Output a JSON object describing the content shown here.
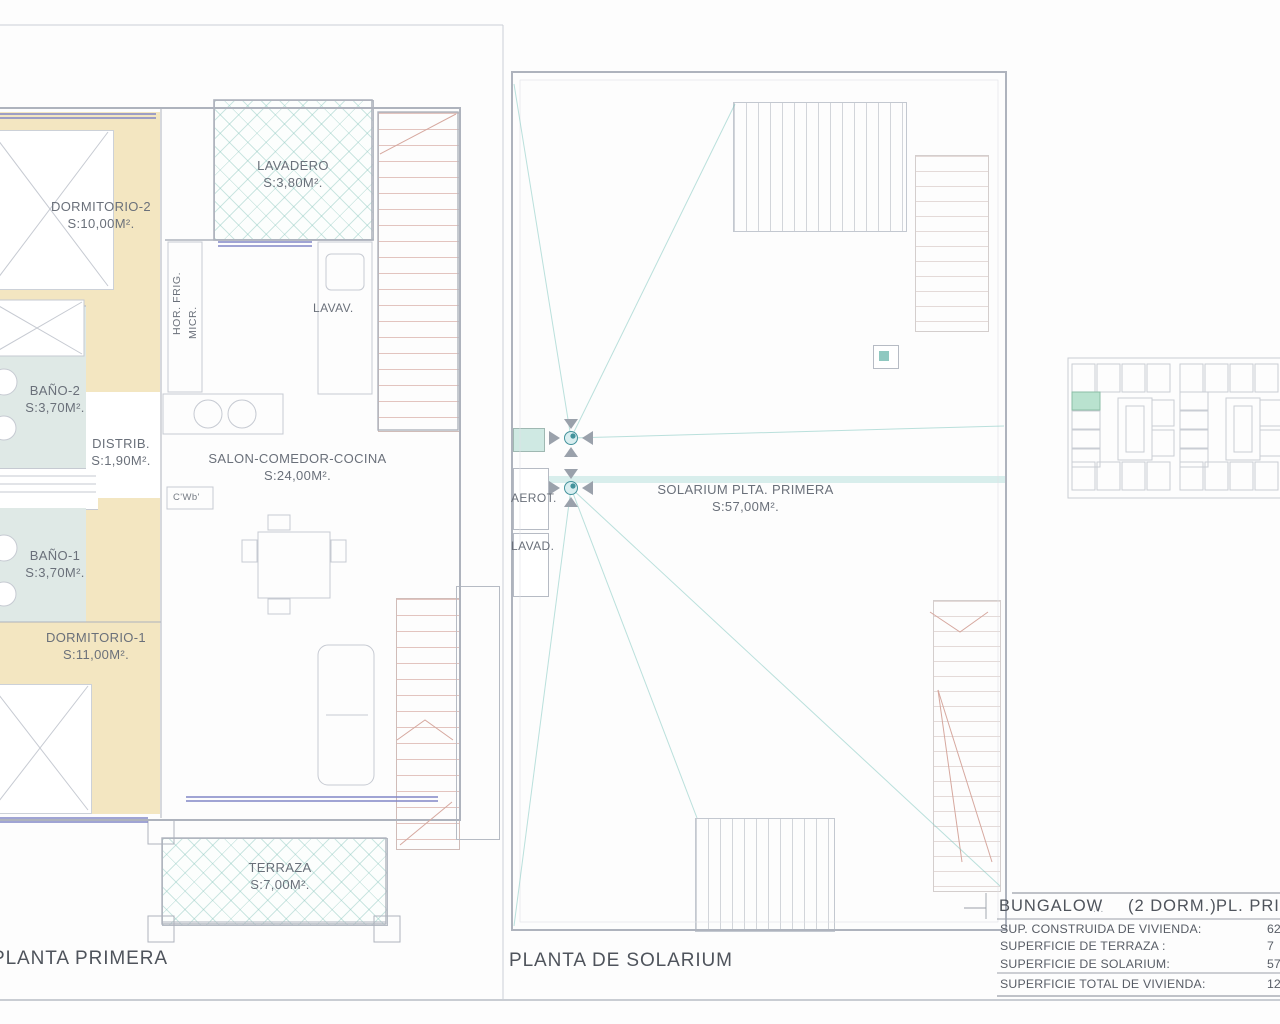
{
  "titles": {
    "left": "PLANTA PRIMERA",
    "right": "PLANTA DE SOLARIUM"
  },
  "left_plan": {
    "rooms": {
      "dormitorio2": {
        "name": "DORMITORIO-2",
        "area": "S:10,00M²."
      },
      "lavadero": {
        "name": "LAVADERO",
        "area": "S:3,80M²."
      },
      "bano2": {
        "name": "BAÑO-2",
        "area": "S:3,70M²."
      },
      "distrib": {
        "name": "DISTRIB.",
        "area": "S:1,90M²."
      },
      "salon": {
        "name": "SALON-COMEDOR-COCINA",
        "area": "S:24,00M²."
      },
      "bano1": {
        "name": "BAÑO-1",
        "area": "S:3,70M²."
      },
      "dormitorio1": {
        "name": "DORMITORIO-1",
        "area": "S:11,00M²."
      },
      "terraza": {
        "name": "TERRAZA",
        "area": "S:7,00M²."
      }
    },
    "annotations": {
      "hor_frig": "HOR. FRIG.",
      "micr": "MICR.",
      "lavav": "LAVAV.",
      "cwb": "C'Wb'"
    }
  },
  "right_plan": {
    "rooms": {
      "solarium": {
        "name": "SOLARIUM PLTA. PRIMERA",
        "area": "S:57,00M²."
      }
    },
    "annotations": {
      "aerot": "AEROT.",
      "lavad": "LAVAD."
    }
  },
  "summary_table": {
    "header": {
      "model": "BUNGALOW",
      "dots": "...",
      "dorms": "(2 DORM.)",
      "floor": "PL. PRIMERA"
    },
    "rows": [
      {
        "label": "SUP. CONSTRUIDA DE VIVIENDA:",
        "value": "62"
      },
      {
        "label": "SUPERFICIE DE TERRAZA :",
        "value": "7"
      },
      {
        "label": "SUPERFICIE  DE SOLARIUM:",
        "value": "57"
      },
      {
        "label": "SUPERFICIE  TOTAL DE VIVIENDA:",
        "value": "126"
      }
    ]
  },
  "colors": {
    "bedroom_fill": "#f3e6c1",
    "bathroom_fill": "#dfe9e6",
    "hatch_teal": "#82c3b9",
    "stair_red": "#cd968c",
    "window_blue": "#8286c6",
    "drain_teal": "#43939c",
    "site_highlight": "#b9e2cf",
    "wall_gray": "#aeb3bd",
    "text_gray": "#6a707a"
  }
}
